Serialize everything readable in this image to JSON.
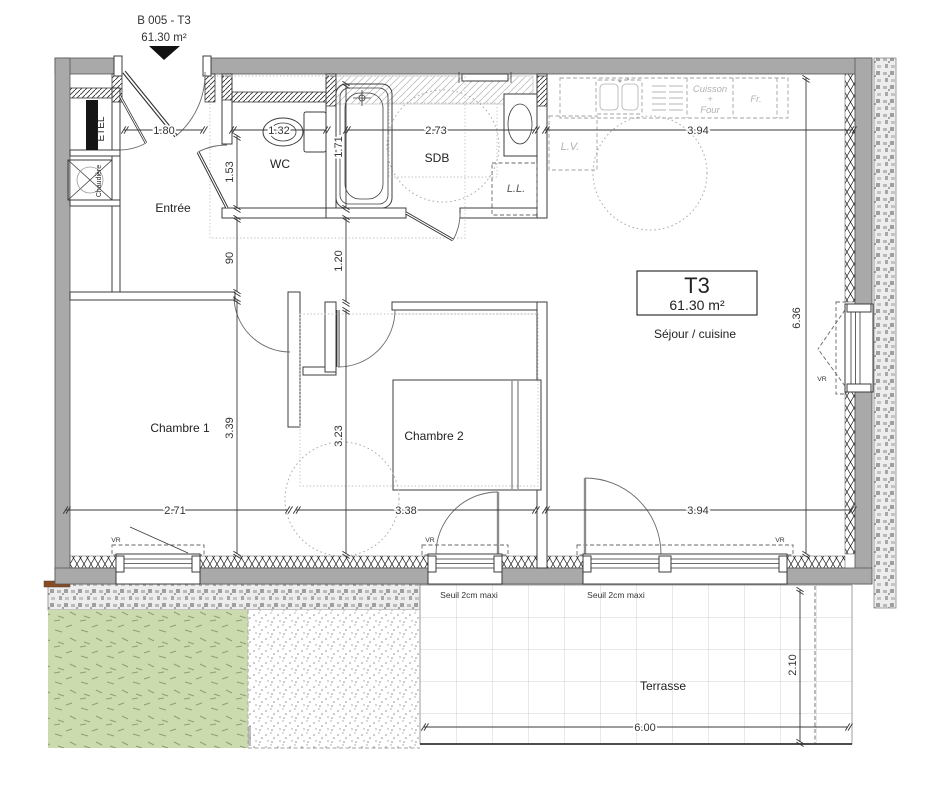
{
  "header": {
    "lot_label": "B 005 - T3",
    "area_label": "61.30 m²"
  },
  "unit_box": {
    "type": "T3",
    "area": "61.30 m²"
  },
  "rooms": {
    "entree": "Entrée",
    "wc": "WC",
    "sdb": "SDB",
    "sejour": "Séjour / cuisine",
    "chambre1": "Chambre 1",
    "chambre2": "Chambre 2",
    "terrasse": "Terrasse"
  },
  "closets": {
    "etel": "ETEL",
    "chaudiere": "Chaudière"
  },
  "kitchen": {
    "lv": "L.V.",
    "ll": "L.L.",
    "cuisson": "Cuisson",
    "plus": "+",
    "four": "Four",
    "fridge": "Fr."
  },
  "windows": {
    "vr": "VR",
    "seuil": "Seuil 2cm maxi"
  },
  "dims": {
    "top": [
      "1.80",
      "1.32",
      "2.73",
      "3.94"
    ],
    "left": [
      "1.53",
      "90",
      "3.39"
    ],
    "mid": [
      "1.71",
      "1.20",
      "3.23"
    ],
    "right": "6.36",
    "bottom": [
      "2.71",
      "3.38",
      "3.94"
    ],
    "terrace_depth": "2.10",
    "terrace_width": "6.00"
  },
  "colors": {
    "wall": "#a9a9a9",
    "lawn": "#ccdbad",
    "lawndash": "#8fa076",
    "masonrybg": "#ededed",
    "tileline": "#c5c5c5",
    "brown": "#8a4a1e",
    "graylabel": "#b2b2b2",
    "dimtext": "#333333"
  }
}
